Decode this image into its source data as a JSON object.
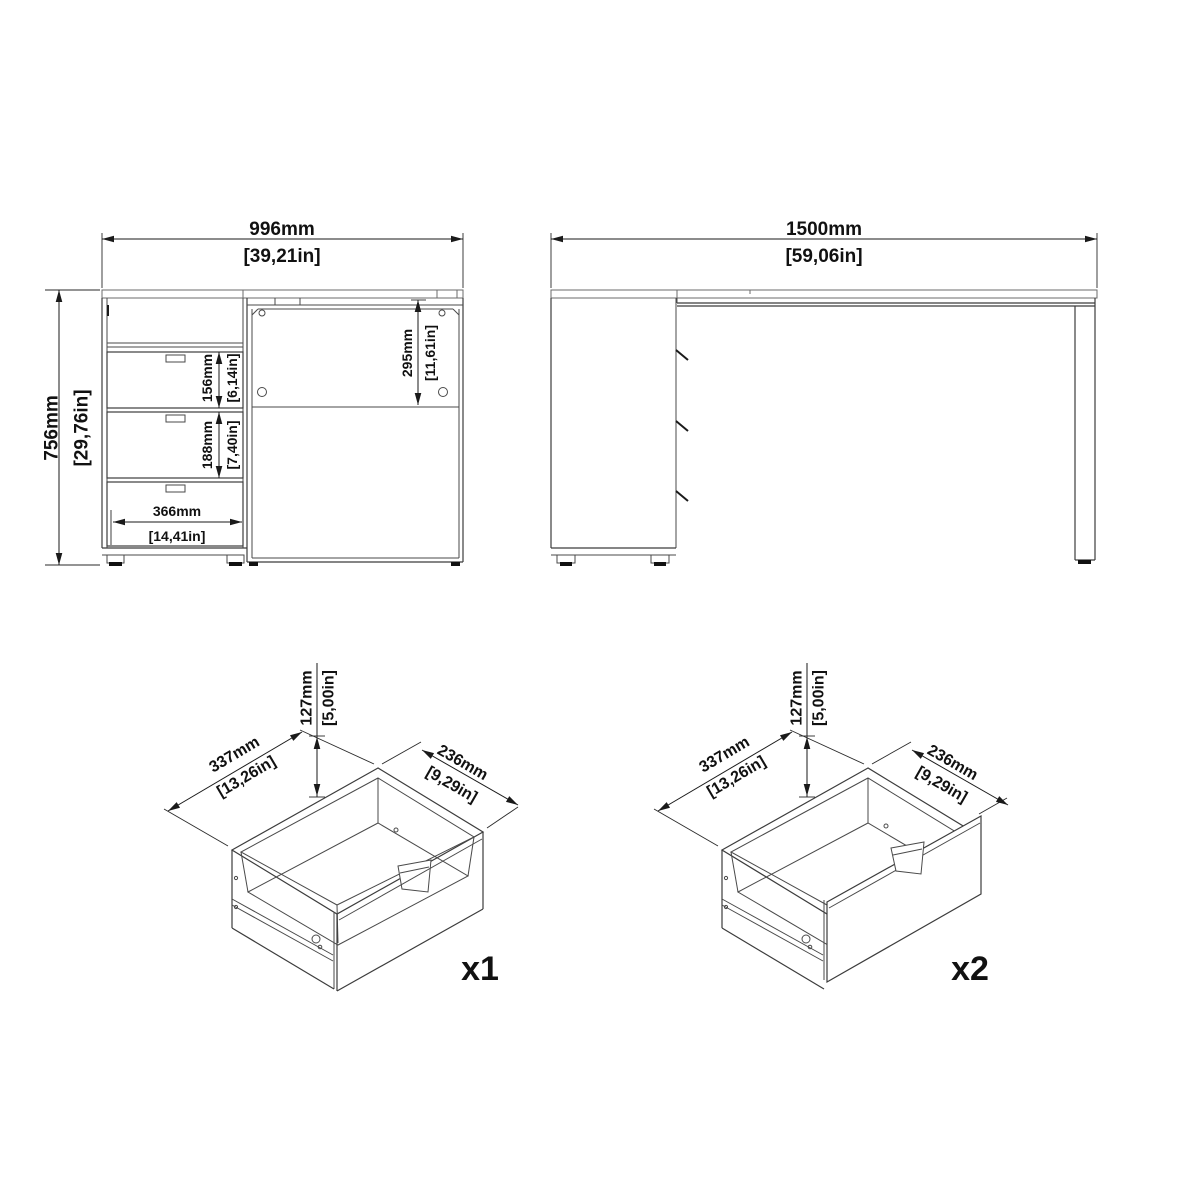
{
  "front_view": {
    "width_mm": "996mm",
    "width_in": "[39,21in]",
    "height_mm": "756mm",
    "height_in": "[29,76in]",
    "top_drawer_mm": "156mm",
    "top_drawer_in": "[6,14in]",
    "middle_drawer_mm": "188mm",
    "middle_drawer_in": "[7,40in]",
    "drawer_width_mm": "366mm",
    "drawer_width_in": "[14,41in]",
    "door_mm": "295mm",
    "door_in": "[11,61in]"
  },
  "side_view": {
    "depth_mm": "1500mm",
    "depth_in": "[59,06in]"
  },
  "drawer_x1": {
    "height_mm": "127mm",
    "height_in": "[5,00in]",
    "width_mm": "337mm",
    "width_in": "[13,26in]",
    "depth_mm": "236mm",
    "depth_in": "[9,29in]",
    "quantity": "x1"
  },
  "drawer_x2": {
    "height_mm": "127mm",
    "height_in": "[5,00in]",
    "width_mm": "337mm",
    "width_in": "[13,26in]",
    "depth_mm": "236mm",
    "depth_in": "[9,29in]",
    "quantity": "x2"
  }
}
